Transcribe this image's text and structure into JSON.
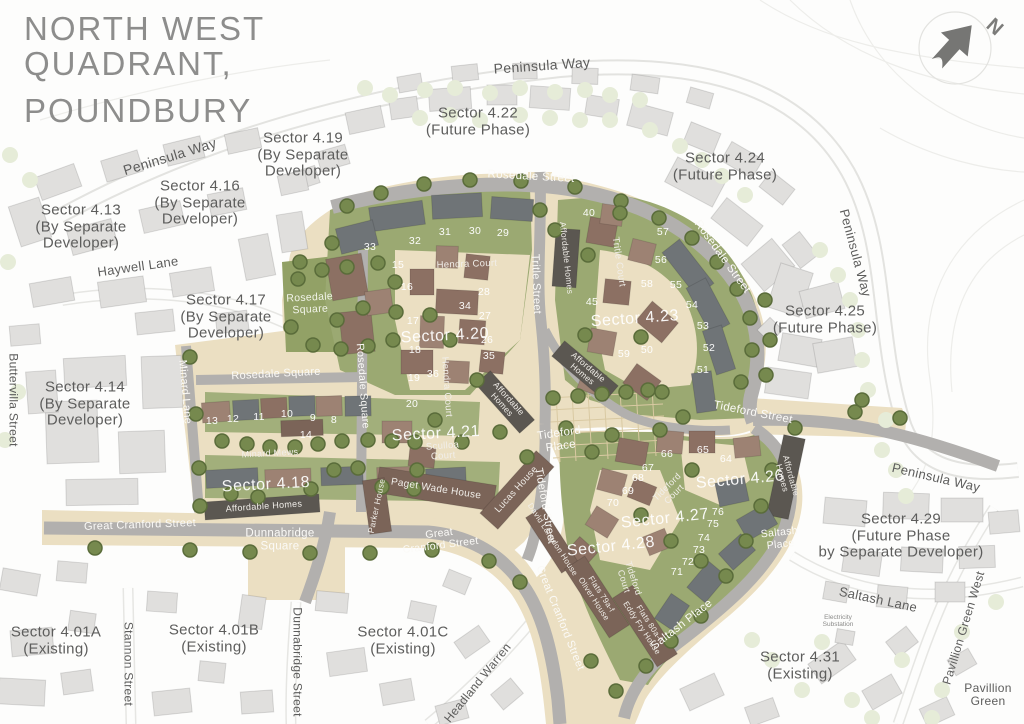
{
  "title": {
    "line1": "NORTH WEST",
    "line2": "QUADRANT,",
    "line3": "POUNDBURY"
  },
  "north_indicator": {
    "label": "N"
  },
  "colors": {
    "cream": "#ebdfc2",
    "road_grey": "#b2b0ae",
    "green": "#9ba972",
    "park_green": "#92a166",
    "dark_building": "#5b5751",
    "brown_roof": "#8c7063",
    "slate_roof": "#6f7477",
    "outside_building": "#e0dfdd",
    "tree": "#76894e",
    "text_grey": "#5d5d5c"
  },
  "sector_labels": [
    {
      "id": "sector-4-13",
      "lines": [
        "Sector 4.13",
        "(By Separate",
        "Developer)"
      ],
      "x": 81,
      "y": 227,
      "size": 15,
      "style": "dark"
    },
    {
      "id": "sector-4-16",
      "lines": [
        "Sector 4.16",
        "(By Separate",
        "Developer)"
      ],
      "x": 200,
      "y": 203,
      "size": 15,
      "style": "dark"
    },
    {
      "id": "sector-4-19",
      "lines": [
        "Sector 4.19",
        "(By Separate",
        "Developer)"
      ],
      "x": 303,
      "y": 155,
      "size": 15,
      "style": "dark"
    },
    {
      "id": "sector-4-22",
      "lines": [
        "Sector 4.22",
        "(Future Phase)"
      ],
      "x": 478,
      "y": 122,
      "size": 15,
      "style": "dark"
    },
    {
      "id": "sector-4-24",
      "lines": [
        "Sector 4.24",
        "(Future Phase)"
      ],
      "x": 725,
      "y": 167,
      "size": 15,
      "style": "dark"
    },
    {
      "id": "sector-4-25",
      "lines": [
        "Sector 4.25",
        "(Future Phase)"
      ],
      "x": 825,
      "y": 320,
      "size": 15,
      "style": "dark"
    },
    {
      "id": "sector-4-17",
      "lines": [
        "Sector 4.17",
        "(By Separate",
        "Developer)"
      ],
      "x": 226,
      "y": 317,
      "size": 15,
      "style": "dark"
    },
    {
      "id": "sector-4-14",
      "lines": [
        "Sector 4.14",
        "(By Separate",
        "Developer)"
      ],
      "x": 85,
      "y": 404,
      "size": 15,
      "style": "dark"
    },
    {
      "id": "sector-4-29",
      "lines": [
        "Sector 4.29",
        "(Future Phase",
        "by Separate Developer)"
      ],
      "x": 901,
      "y": 536,
      "size": 15,
      "style": "dark"
    },
    {
      "id": "sector-4-31",
      "lines": [
        "Sector 4.31",
        "(Existing)"
      ],
      "x": 800,
      "y": 666,
      "size": 15,
      "style": "dark"
    },
    {
      "id": "sector-4-01a",
      "lines": [
        "Sector 4.01A",
        "(Existing)"
      ],
      "x": 56,
      "y": 641,
      "size": 15,
      "style": "dark"
    },
    {
      "id": "sector-4-01b",
      "lines": [
        "Sector 4.01B",
        "(Existing)"
      ],
      "x": 214,
      "y": 639,
      "size": 15,
      "style": "dark"
    },
    {
      "id": "sector-4-01c",
      "lines": [
        "Sector 4.01C",
        "(Existing)"
      ],
      "x": 403,
      "y": 641,
      "size": 15,
      "style": "dark"
    },
    {
      "id": "sector-4-20",
      "lines": [
        "Sector 4.20"
      ],
      "x": 445,
      "y": 336,
      "rot": -3,
      "size": 16,
      "style": "onmap"
    },
    {
      "id": "sector-4-21",
      "lines": [
        "Sector 4.21"
      ],
      "x": 436,
      "y": 434,
      "rot": -3,
      "size": 16,
      "style": "onmap"
    },
    {
      "id": "sector-4-23",
      "lines": [
        "Sector 4.23"
      ],
      "x": 635,
      "y": 319,
      "rot": -4,
      "size": 16,
      "style": "onmap"
    },
    {
      "id": "sector-4-18",
      "lines": [
        "Sector 4.18"
      ],
      "x": 266,
      "y": 485,
      "rot": -3,
      "size": 16,
      "style": "onmap"
    },
    {
      "id": "sector-4-26",
      "lines": [
        "Sector 4.26"
      ],
      "x": 740,
      "y": 480,
      "rot": -5,
      "size": 16,
      "style": "onmap"
    },
    {
      "id": "sector-4-27",
      "lines": [
        "Sector 4.27"
      ],
      "x": 665,
      "y": 519,
      "rot": -6,
      "size": 16,
      "style": "onmap"
    },
    {
      "id": "sector-4-28",
      "lines": [
        "Sector 4.28"
      ],
      "x": 611,
      "y": 547,
      "rot": -6,
      "size": 16,
      "style": "onmap"
    }
  ],
  "street_labels": [
    {
      "id": "peninsula-way-nw",
      "lines": [
        "Peninsula Way"
      ],
      "x": 170,
      "y": 157,
      "rot": -17,
      "size": 14,
      "style": "dark"
    },
    {
      "id": "peninsula-way-top",
      "lines": [
        "Peninsula Way"
      ],
      "x": 542,
      "y": 66,
      "rot": -4,
      "size": 14,
      "style": "dark"
    },
    {
      "id": "peninsula-way-east",
      "lines": [
        "Peninsula Way"
      ],
      "x": 855,
      "y": 253,
      "rot": 75,
      "size": 13,
      "style": "dark"
    },
    {
      "id": "peninsula-way-se",
      "lines": [
        "Peninsula Way"
      ],
      "x": 936,
      "y": 478,
      "rot": 13,
      "size": 13,
      "style": "dark"
    },
    {
      "id": "haywell-lane",
      "lines": [
        "Haywell Lane"
      ],
      "x": 138,
      "y": 267,
      "rot": -8,
      "size": 13,
      "style": "dark"
    },
    {
      "id": "buttervilla-street",
      "lines": [
        "Buttervilla Street"
      ],
      "x": 13,
      "y": 400,
      "rot": 90,
      "size": 12,
      "style": "dark"
    },
    {
      "id": "minard-lane",
      "lines": [
        "Minard Lane"
      ],
      "x": 185,
      "y": 392,
      "rot": 85,
      "size": 11,
      "style": "light"
    },
    {
      "id": "stannon-street",
      "lines": [
        "Stannon Street"
      ],
      "x": 128,
      "y": 664,
      "rot": 90,
      "size": 12,
      "style": "dark"
    },
    {
      "id": "dunnabridge-street",
      "lines": [
        "Dunnabridge Street"
      ],
      "x": 297,
      "y": 662,
      "rot": 90,
      "size": 12,
      "style": "dark"
    },
    {
      "id": "headland-warren",
      "lines": [
        "Headland Warren"
      ],
      "x": 478,
      "y": 683,
      "rot": -51,
      "size": 12,
      "style": "dark"
    },
    {
      "id": "saltash-lane",
      "lines": [
        "Saltash Lane"
      ],
      "x": 878,
      "y": 600,
      "rot": 12,
      "size": 13,
      "style": "dark"
    },
    {
      "id": "pavillion-green-west",
      "lines": [
        "Pavillion Green West"
      ],
      "x": 964,
      "y": 628,
      "rot": -73,
      "size": 12,
      "style": "dark"
    },
    {
      "id": "pavillion-green",
      "lines": [
        "Pavillion",
        "Green"
      ],
      "x": 988,
      "y": 695,
      "rot": 0,
      "size": 12,
      "style": "dark"
    },
    {
      "id": "rosedale-street-top",
      "lines": [
        "Rosedale Street"
      ],
      "x": 531,
      "y": 177,
      "rot": 3,
      "size": 11.5,
      "style": "light"
    },
    {
      "id": "rosedale-street-east",
      "lines": [
        "Rosedale Street"
      ],
      "x": 722,
      "y": 257,
      "rot": 54,
      "size": 11.5,
      "style": "light"
    },
    {
      "id": "rosedale-square-street",
      "lines": [
        "Rosedale Square"
      ],
      "x": 276,
      "y": 374,
      "rot": -3,
      "size": 11,
      "style": "light"
    },
    {
      "id": "rosedale-square-vertical",
      "lines": [
        "Rosedale Square"
      ],
      "x": 362,
      "y": 386,
      "rot": 86,
      "size": 10.5,
      "style": "light"
    },
    {
      "id": "tritle-street",
      "lines": [
        "Tritle Street"
      ],
      "x": 536,
      "y": 284,
      "rot": 88,
      "size": 11,
      "style": "light"
    },
    {
      "id": "tideford-street-east",
      "lines": [
        "Tideford Street"
      ],
      "x": 753,
      "y": 413,
      "rot": 11,
      "size": 11.5,
      "style": "light"
    },
    {
      "id": "tideford-street-center",
      "lines": [
        "Tideford Street"
      ],
      "x": 545,
      "y": 506,
      "rot": 80,
      "size": 11,
      "style": "light"
    },
    {
      "id": "great-cranford-street-west",
      "lines": [
        "Great Cranford Street"
      ],
      "x": 140,
      "y": 525,
      "rot": -2,
      "size": 11,
      "style": "light"
    },
    {
      "id": "great-cranford-street-center",
      "lines": [
        "Great",
        "Cranford Street"
      ],
      "x": 440,
      "y": 540,
      "rot": -7,
      "size": 10.5,
      "style": "light"
    },
    {
      "id": "great-cranford-street-south",
      "lines": [
        "Great Cranford Street"
      ],
      "x": 560,
      "y": 618,
      "rot": 68,
      "size": 11,
      "style": "light"
    },
    {
      "id": "dunnabridge-square",
      "lines": [
        "Dunnabridge",
        "Square"
      ],
      "x": 280,
      "y": 540,
      "rot": 0,
      "size": 11.5,
      "style": "light"
    },
    {
      "id": "tideford-place",
      "lines": [
        "Tideford",
        "Place"
      ],
      "x": 560,
      "y": 440,
      "rot": -8,
      "size": 11.5,
      "style": "light"
    },
    {
      "id": "saltash-place-street",
      "lines": [
        "Saltash Place"
      ],
      "x": 682,
      "y": 625,
      "rot": -38,
      "size": 11.5,
      "style": "light"
    },
    {
      "id": "saltash-place-label",
      "lines": [
        "Saltash",
        "Place"
      ],
      "x": 780,
      "y": 539,
      "rot": -6,
      "size": 10.5,
      "style": "light"
    },
    {
      "id": "rosedale-square-park",
      "lines": [
        "Rosedale",
        "Square"
      ],
      "x": 310,
      "y": 304,
      "rot": -3,
      "size": 10.5,
      "style": "greenlbl"
    }
  ],
  "building_labels": [
    {
      "id": "hendra-court",
      "lines": [
        "Hendra Court"
      ],
      "x": 467,
      "y": 265,
      "rot": -2,
      "size": 9.5
    },
    {
      "id": "hendra-court-vertical",
      "lines": [
        "Hendra Court"
      ],
      "x": 446,
      "y": 387,
      "rot": 86,
      "size": 9.5
    },
    {
      "id": "tritle-court",
      "lines": [
        "Tritle Court"
      ],
      "x": 618,
      "y": 262,
      "rot": 82,
      "size": 9.5
    },
    {
      "id": "sculloa-court",
      "lines": [
        "Sculloa",
        "Court"
      ],
      "x": 443,
      "y": 452,
      "rot": -4,
      "size": 9.5
    },
    {
      "id": "paget-wade-house",
      "lines": [
        "Paget Wade House"
      ],
      "x": 436,
      "y": 489,
      "rot": 9,
      "size": 10
    },
    {
      "id": "lucas-house",
      "lines": [
        "Lucas House"
      ],
      "x": 517,
      "y": 490,
      "rot": -48,
      "size": 9.5
    },
    {
      "id": "parker-house",
      "lines": [
        "Parker House"
      ],
      "x": 377,
      "y": 506,
      "rot": -78,
      "size": 8.5
    },
    {
      "id": "david-langdon-house",
      "lines": [
        "David Langdon House"
      ],
      "x": 552,
      "y": 540,
      "rot": 57,
      "size": 8
    },
    {
      "id": "oliver-house",
      "lines": [
        "Flats 79a-f",
        "Oliver House"
      ],
      "x": 597,
      "y": 597,
      "rot": 57,
      "size": 8
    },
    {
      "id": "eddy-fry-house",
      "lines": [
        "Flats 80a-f",
        "Eddy Fry House"
      ],
      "x": 645,
      "y": 626,
      "rot": 57,
      "size": 8
    },
    {
      "id": "tideford-court-1",
      "lines": [
        "Tideford",
        "Court"
      ],
      "x": 671,
      "y": 491,
      "rot": -45,
      "size": 9
    },
    {
      "id": "tideford-court-2",
      "lines": [
        "Tideford",
        "Court"
      ],
      "x": 628,
      "y": 580,
      "rot": 72,
      "size": 9
    },
    {
      "id": "affordable-homes-423",
      "lines": [
        "Affordable Homes"
      ],
      "x": 566,
      "y": 258,
      "rot": 84,
      "size": 8.5
    },
    {
      "id": "affordable-homes-center-right",
      "lines": [
        "Affordable",
        "Homes"
      ],
      "x": 585,
      "y": 371,
      "rot": 40,
      "size": 8.5
    },
    {
      "id": "affordable-homes-center-left",
      "lines": [
        "Affordable",
        "Homes"
      ],
      "x": 505,
      "y": 402,
      "rot": 48,
      "size": 8.5
    },
    {
      "id": "affordable-homes-418",
      "lines": [
        "Affordable Homes"
      ],
      "x": 264,
      "y": 507,
      "rot": -4,
      "size": 9
    },
    {
      "id": "affordable-homes-426",
      "lines": [
        "Affordable",
        "Homes"
      ],
      "x": 786,
      "y": 477,
      "rot": 75,
      "size": 8.5
    },
    {
      "id": "minard-mews",
      "lines": [
        "Minard Mews"
      ],
      "x": 270,
      "y": 454,
      "rot": -3,
      "size": 9
    }
  ],
  "misc_labels": [
    {
      "id": "electricity-substation",
      "lines": [
        "Electricity",
        "Substation"
      ],
      "x": 838,
      "y": 621,
      "rot": 0,
      "size": 6.5,
      "style": "tiny"
    }
  ],
  "plot_numbers": [
    {
      "n": "8",
      "x": 334,
      "y": 421
    },
    {
      "n": "9",
      "x": 313,
      "y": 419
    },
    {
      "n": "10",
      "x": 287,
      "y": 415
    },
    {
      "n": "11",
      "x": 259,
      "y": 418
    },
    {
      "n": "12",
      "x": 233,
      "y": 420
    },
    {
      "n": "13",
      "x": 212,
      "y": 422
    },
    {
      "n": "14",
      "x": 306,
      "y": 436
    },
    {
      "n": "15",
      "x": 398,
      "y": 266
    },
    {
      "n": "16",
      "x": 407,
      "y": 288
    },
    {
      "n": "17",
      "x": 413,
      "y": 322
    },
    {
      "n": "18",
      "x": 415,
      "y": 351
    },
    {
      "n": "19",
      "x": 414,
      "y": 379
    },
    {
      "n": "20",
      "x": 412,
      "y": 405
    },
    {
      "n": "26",
      "x": 487,
      "y": 341
    },
    {
      "n": "27",
      "x": 485,
      "y": 317
    },
    {
      "n": "28",
      "x": 484,
      "y": 293
    },
    {
      "n": "29",
      "x": 503,
      "y": 234
    },
    {
      "n": "30",
      "x": 475,
      "y": 232
    },
    {
      "n": "31",
      "x": 445,
      "y": 233
    },
    {
      "n": "32",
      "x": 415,
      "y": 242
    },
    {
      "n": "33",
      "x": 370,
      "y": 248
    },
    {
      "n": "34",
      "x": 465,
      "y": 307
    },
    {
      "n": "35",
      "x": 489,
      "y": 357
    },
    {
      "n": "36",
      "x": 433,
      "y": 375
    },
    {
      "n": "40",
      "x": 589,
      "y": 214
    },
    {
      "n": "45",
      "x": 592,
      "y": 303
    },
    {
      "n": "50",
      "x": 647,
      "y": 351
    },
    {
      "n": "51",
      "x": 703,
      "y": 371
    },
    {
      "n": "52",
      "x": 709,
      "y": 349
    },
    {
      "n": "53",
      "x": 703,
      "y": 327
    },
    {
      "n": "54",
      "x": 692,
      "y": 306
    },
    {
      "n": "55",
      "x": 676,
      "y": 286
    },
    {
      "n": "56",
      "x": 661,
      "y": 261
    },
    {
      "n": "57",
      "x": 663,
      "y": 233
    },
    {
      "n": "58",
      "x": 647,
      "y": 285
    },
    {
      "n": "59",
      "x": 624,
      "y": 355
    },
    {
      "n": "64",
      "x": 726,
      "y": 460
    },
    {
      "n": "65",
      "x": 703,
      "y": 451
    },
    {
      "n": "66",
      "x": 667,
      "y": 455
    },
    {
      "n": "67",
      "x": 648,
      "y": 469
    },
    {
      "n": "68",
      "x": 638,
      "y": 479
    },
    {
      "n": "69",
      "x": 628,
      "y": 492
    },
    {
      "n": "70",
      "x": 613,
      "y": 504
    },
    {
      "n": "71",
      "x": 677,
      "y": 573
    },
    {
      "n": "72",
      "x": 688,
      "y": 563
    },
    {
      "n": "73",
      "x": 699,
      "y": 551
    },
    {
      "n": "74",
      "x": 704,
      "y": 539
    },
    {
      "n": "75",
      "x": 713,
      "y": 525
    },
    {
      "n": "76",
      "x": 718,
      "y": 513
    }
  ]
}
